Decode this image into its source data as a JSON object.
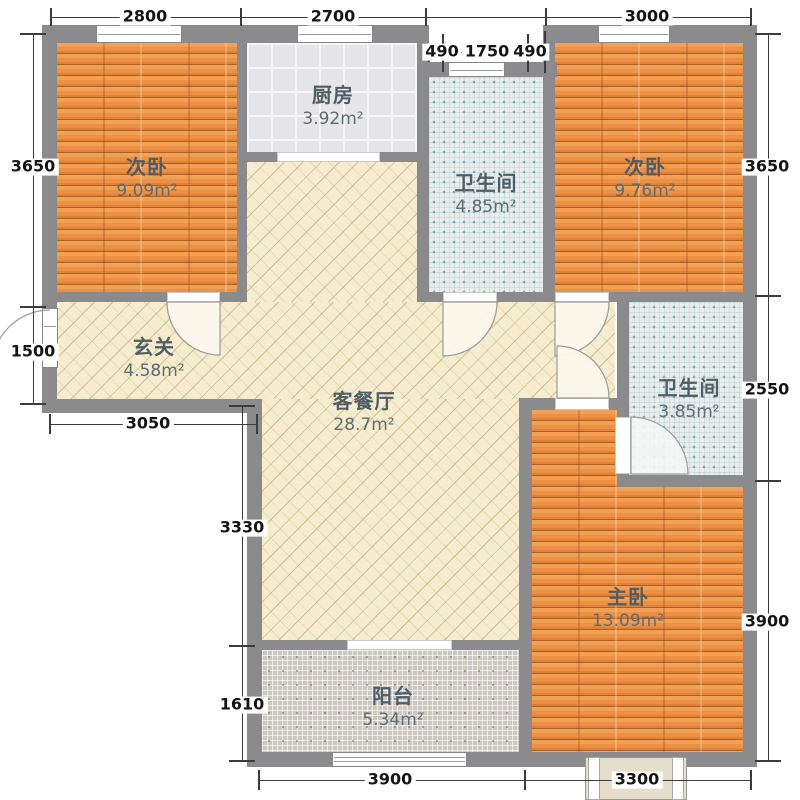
{
  "floorplan": {
    "rooms": [
      {
        "id": "bedroom-top-left",
        "name": "次卧",
        "area": "9.09m²"
      },
      {
        "id": "kitchen",
        "name": "厨房",
        "area": "3.92m²"
      },
      {
        "id": "bath-top",
        "name": "卫生间",
        "area": "4.85m²"
      },
      {
        "id": "bedroom-top-right",
        "name": "次卧",
        "area": "9.76m²"
      },
      {
        "id": "entry-hall",
        "name": "玄关",
        "area": "4.58m²"
      },
      {
        "id": "living-dining",
        "name": "客餐厅",
        "area": "28.7m²"
      },
      {
        "id": "bath-right",
        "name": "卫生间",
        "area": "3.85m²"
      },
      {
        "id": "master-bedroom",
        "name": "主卧",
        "area": "13.09m²"
      },
      {
        "id": "balcony",
        "name": "阳台",
        "area": "5.34m²"
      }
    ],
    "dimensions": {
      "top": [
        "2800",
        "2700",
        "3000"
      ],
      "top_sub": [
        "490",
        "1750",
        "490"
      ],
      "left": [
        "3650",
        "1500"
      ],
      "left_inner": [
        "3050",
        "3330",
        "1610"
      ],
      "right": [
        "3650",
        "2550",
        "3900"
      ],
      "bottom": [
        "3900",
        "3300"
      ]
    },
    "colors": {
      "wall": "#8b8b8d",
      "wood_floor": "#e5873b",
      "kitchen_tile": "#e6e6e8",
      "bath_tile": "#e8eeee",
      "living_floor": "#f6ecce",
      "balcony_mosaic": "#ccc7bf",
      "label_text": "#4e5d66",
      "dimension_text": "#151515"
    }
  }
}
